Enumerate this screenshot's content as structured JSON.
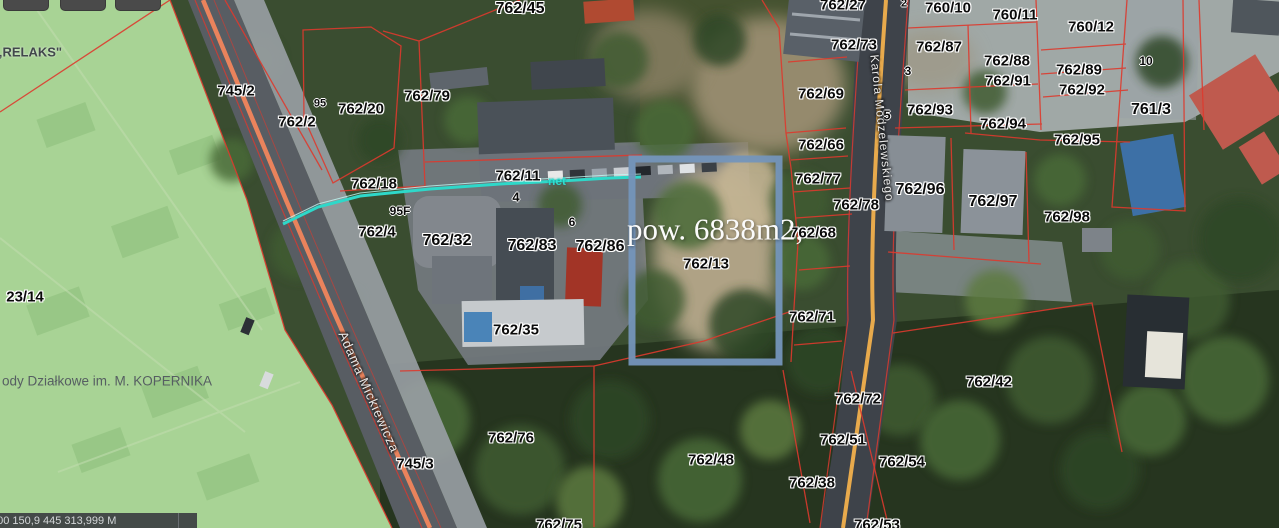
{
  "map": {
    "statusbar": {
      "coords": "500 150,9 445 313,999 M"
    },
    "highlight": {
      "parcel": "762/13",
      "area_text": "pow. 6838m2,",
      "border_color": "#7495bb"
    },
    "colors": {
      "boundary_red": "#dd3a2e",
      "road_edge_orange": "#f2855c",
      "road_center_yellow": "#e8aa4c",
      "utility_teal": "#2ed8c9",
      "highlight_blue": "#7495bb",
      "green_zone": "#a8d395"
    },
    "labels": [
      {
        "t": "„RELAKS\"",
        "x": 29,
        "y": 52,
        "k": "z",
        "n": "zone-label-relaks"
      },
      {
        "t": "23/14",
        "x": 25,
        "y": 297,
        "k": "p",
        "n": "parcel-label"
      },
      {
        "t": "ody Działkowe im. M. KOPERNIKA",
        "x": 2,
        "y": 381,
        "k": "cap",
        "n": "zone-label-kopernika"
      },
      {
        "t": "745/2",
        "x": 236,
        "y": 91,
        "k": "p",
        "n": "parcel-label"
      },
      {
        "t": "762/2",
        "x": 297,
        "y": 122,
        "k": "p",
        "n": "parcel-label"
      },
      {
        "t": "762/20",
        "x": 361,
        "y": 109,
        "k": "p",
        "n": "parcel-label"
      },
      {
        "t": "762/79",
        "x": 427,
        "y": 96,
        "k": "p",
        "n": "parcel-label"
      },
      {
        "t": "762/45",
        "x": 520,
        "y": 9,
        "k": "p",
        "fs": 16,
        "n": "parcel-label"
      },
      {
        "t": "762/18",
        "x": 374,
        "y": 184,
        "k": "p",
        "n": "parcel-label"
      },
      {
        "t": "762/11",
        "x": 518,
        "y": 176,
        "k": "p",
        "n": "parcel-label"
      },
      {
        "t": "762/4",
        "x": 377,
        "y": 232,
        "k": "p",
        "n": "parcel-label"
      },
      {
        "t": "762/32",
        "x": 447,
        "y": 241,
        "k": "p",
        "fs": 16,
        "n": "parcel-label"
      },
      {
        "t": "762/83",
        "x": 532,
        "y": 246,
        "k": "p",
        "fs": 16,
        "n": "parcel-label"
      },
      {
        "t": "762/86",
        "x": 600,
        "y": 247,
        "k": "p",
        "fs": 16,
        "n": "parcel-label"
      },
      {
        "t": "762/35",
        "x": 516,
        "y": 330,
        "k": "p",
        "n": "parcel-label"
      },
      {
        "t": "762/13",
        "x": 706,
        "y": 264,
        "k": "p",
        "n": "parcel-label"
      },
      {
        "t": "745/3",
        "x": 415,
        "y": 464,
        "k": "p",
        "n": "parcel-label"
      },
      {
        "t": "762/76",
        "x": 511,
        "y": 438,
        "k": "p",
        "n": "parcel-label"
      },
      {
        "t": "762/75",
        "x": 559,
        "y": 525,
        "k": "p",
        "n": "parcel-label"
      },
      {
        "t": "762/48",
        "x": 711,
        "y": 460,
        "k": "p",
        "n": "parcel-label"
      },
      {
        "t": "762/38",
        "x": 812,
        "y": 483,
        "k": "p",
        "n": "parcel-label"
      },
      {
        "t": "762/53",
        "x": 877,
        "y": 525,
        "k": "p",
        "n": "parcel-label"
      },
      {
        "t": "762/51",
        "x": 843,
        "y": 440,
        "k": "p",
        "n": "parcel-label"
      },
      {
        "t": "762/54",
        "x": 902,
        "y": 462,
        "k": "p",
        "n": "parcel-label"
      },
      {
        "t": "762/72",
        "x": 858,
        "y": 399,
        "k": "p",
        "n": "parcel-label"
      },
      {
        "t": "762/42",
        "x": 989,
        "y": 382,
        "k": "p",
        "n": "parcel-label"
      },
      {
        "t": "762/71",
        "x": 812,
        "y": 317,
        "k": "p",
        "n": "parcel-label"
      },
      {
        "t": "762/68",
        "x": 813,
        "y": 233,
        "k": "p",
        "n": "parcel-label"
      },
      {
        "t": "762/78",
        "x": 856,
        "y": 205,
        "k": "p",
        "n": "parcel-label"
      },
      {
        "t": "762/77",
        "x": 818,
        "y": 179,
        "k": "p",
        "n": "parcel-label"
      },
      {
        "t": "762/66",
        "x": 821,
        "y": 145,
        "k": "p",
        "n": "parcel-label"
      },
      {
        "t": "762/69",
        "x": 821,
        "y": 94,
        "k": "p",
        "n": "parcel-label"
      },
      {
        "t": "762/96",
        "x": 920,
        "y": 190,
        "k": "p",
        "fs": 16,
        "n": "parcel-label"
      },
      {
        "t": "762/97",
        "x": 993,
        "y": 202,
        "k": "p",
        "fs": 16,
        "n": "parcel-label"
      },
      {
        "t": "762/98",
        "x": 1067,
        "y": 217,
        "k": "p",
        "n": "parcel-label"
      },
      {
        "t": "762/93",
        "x": 930,
        "y": 110,
        "k": "p",
        "n": "parcel-label"
      },
      {
        "t": "762/94",
        "x": 1003,
        "y": 124,
        "k": "p",
        "n": "parcel-label"
      },
      {
        "t": "762/95",
        "x": 1077,
        "y": 140,
        "k": "p",
        "n": "parcel-label"
      },
      {
        "t": "762/87",
        "x": 939,
        "y": 47,
        "k": "p",
        "n": "parcel-label"
      },
      {
        "t": "762/88",
        "x": 1007,
        "y": 61,
        "k": "p",
        "n": "parcel-label"
      },
      {
        "t": "762/91",
        "x": 1008,
        "y": 81,
        "k": "p",
        "n": "parcel-label"
      },
      {
        "t": "762/89",
        "x": 1079,
        "y": 70,
        "k": "p",
        "n": "parcel-label"
      },
      {
        "t": "762/92",
        "x": 1082,
        "y": 90,
        "k": "p",
        "n": "parcel-label"
      },
      {
        "t": "760/10",
        "x": 948,
        "y": 8,
        "k": "p",
        "n": "parcel-label"
      },
      {
        "t": "760/11",
        "x": 1015,
        "y": 15,
        "k": "p",
        "n": "parcel-label"
      },
      {
        "t": "760/12",
        "x": 1091,
        "y": 27,
        "k": "p",
        "n": "parcel-label"
      },
      {
        "t": "761/3",
        "x": 1151,
        "y": 110,
        "k": "p",
        "fs": 16,
        "n": "parcel-label"
      },
      {
        "t": "762/73",
        "x": 854,
        "y": 45,
        "k": "p",
        "n": "parcel-label"
      },
      {
        "t": "762/27",
        "x": 843,
        "y": 5,
        "k": "p",
        "n": "parcel-label"
      },
      {
        "t": "95",
        "x": 320,
        "y": 104,
        "k": "h",
        "fs": 11,
        "n": "house-number"
      },
      {
        "t": "95F",
        "x": 400,
        "y": 211,
        "k": "h",
        "n": "house-number"
      },
      {
        "t": "4",
        "x": 516,
        "y": 197,
        "k": "h",
        "fs": 13,
        "n": "house-number"
      },
      {
        "t": "6",
        "x": 572,
        "y": 222,
        "k": "h",
        "n": "house-number"
      },
      {
        "t": "3",
        "x": 908,
        "y": 71,
        "k": "h",
        "n": "house-number"
      },
      {
        "t": "5",
        "x": 887,
        "y": 115,
        "k": "h",
        "fs": 13,
        "n": "house-number"
      },
      {
        "t": "10",
        "x": 1146,
        "y": 61,
        "k": "h",
        "n": "house-number"
      },
      {
        "t": "2",
        "x": 904,
        "y": 4,
        "k": "h",
        "fs": 11,
        "n": "house-number"
      },
      {
        "t": "net",
        "x": 557,
        "y": 181,
        "k": "net",
        "n": "utility-label"
      },
      {
        "t": "Adama Mickiewicza",
        "x": 369,
        "y": 392,
        "k": "st",
        "rot": 66,
        "n": "street-name-mickiewicza"
      },
      {
        "t": "Karola Modzelewskiego",
        "x": 882,
        "y": 128,
        "k": "st",
        "rot": 84,
        "fs": 12,
        "n": "street-name-modzelewskiego"
      },
      {
        "t": "pow. 6838m2,",
        "x": 627,
        "y": 229,
        "k": "area",
        "n": "area-annotation"
      }
    ]
  }
}
